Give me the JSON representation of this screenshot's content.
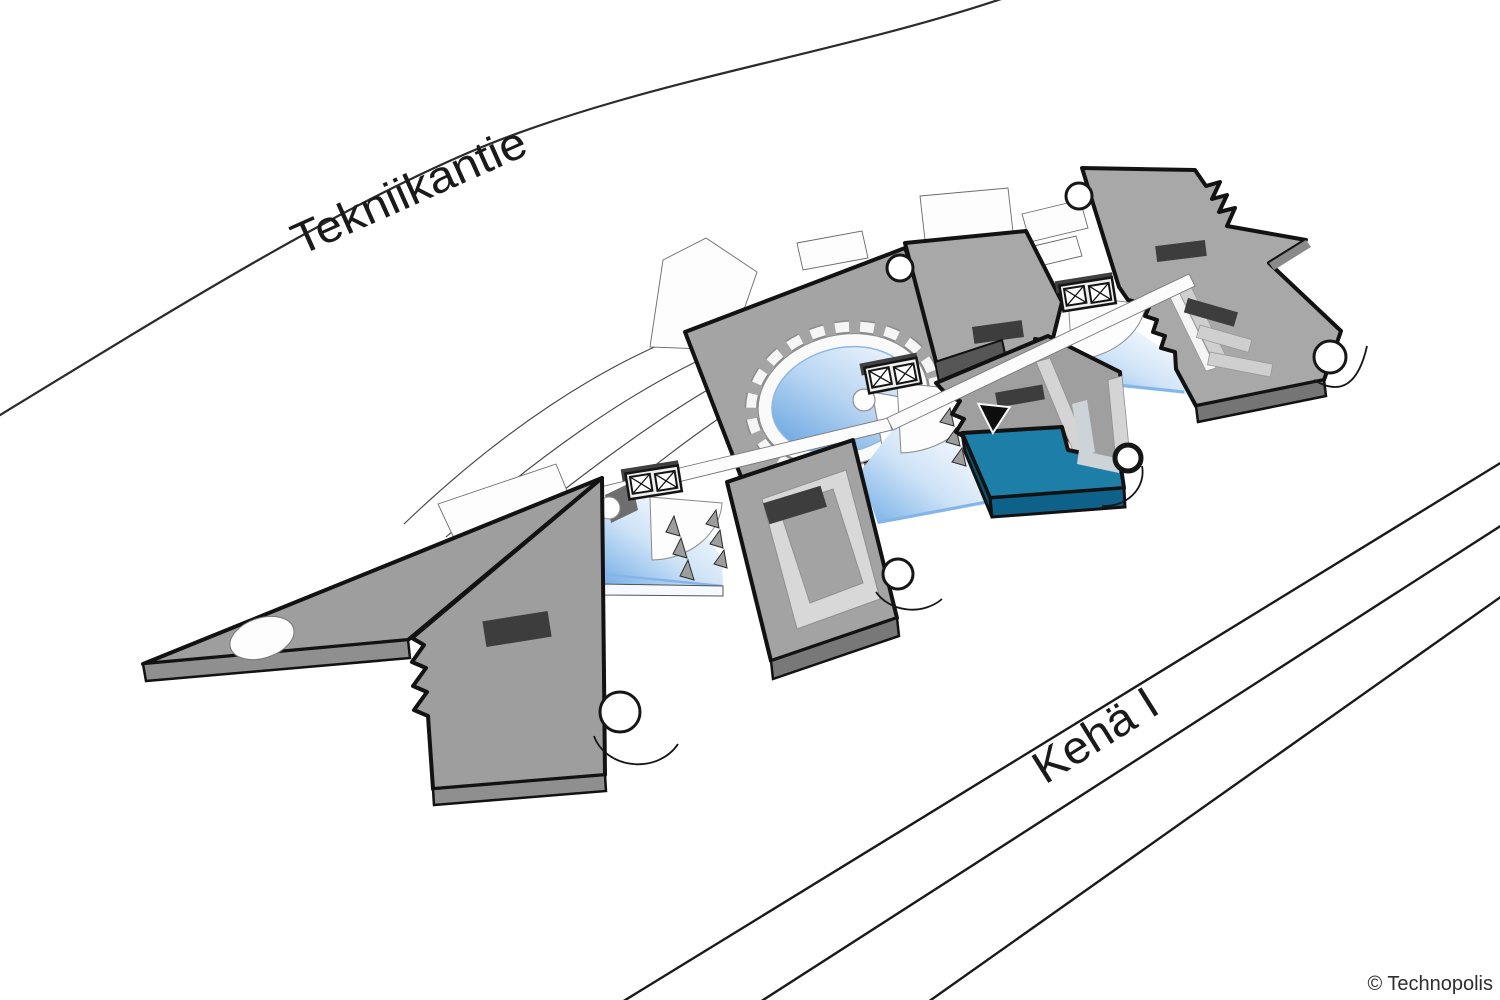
{
  "roads": {
    "tekniikantie": {
      "label": "Tekniikantie"
    },
    "keha_i": {
      "label": "Kehä I"
    }
  },
  "footer": {
    "copyright": "© Technopolis"
  },
  "campus": {
    "buildings": [
      {
        "id": "west-arrow-building",
        "highlighted": false
      },
      {
        "id": "rotunda-atrium-building",
        "highlighted": false
      },
      {
        "id": "south-courtyard-building",
        "highlighted": false
      },
      {
        "id": "north-slab-building",
        "highlighted": false
      },
      {
        "id": "selected-building",
        "highlighted": true,
        "highlight_color": "#1D7FA8"
      },
      {
        "id": "east-e-courtyard-building",
        "highlighted": false
      }
    ],
    "marker": {
      "icon": "location-triangle-marker",
      "points_to": "selected-building"
    },
    "icons": {
      "elevator": "boxed-x-icon",
      "stair_tower": "cylinder-icon"
    }
  },
  "colors": {
    "background": "#FFFFFF",
    "roof_gray": "#A7A7A7",
    "side_gray": "#787878",
    "outline_dark": "#121212",
    "skylight_dark": "#3D3D3D",
    "courtyard_light": "#D7D7D7",
    "highlight_teal": "#1D7FA8",
    "highlight_teal_shadow": "#0E6189",
    "glass_blue": "#7DB3E8",
    "pool_blue": "#66A3E0",
    "road_line": "#1A1A1A",
    "label_text": "#1A1A1A"
  }
}
